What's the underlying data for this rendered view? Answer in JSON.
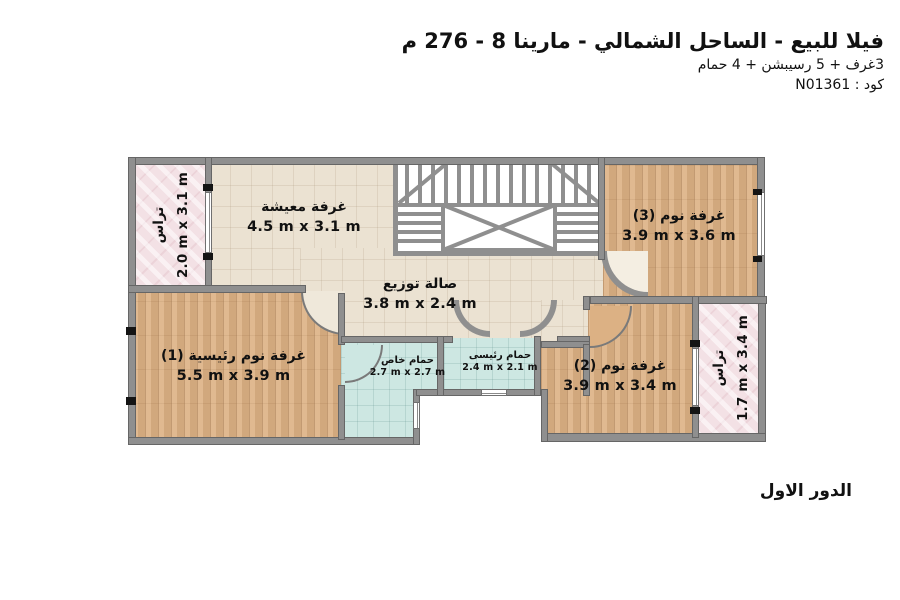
{
  "header": {
    "title": "فيلا للبيع - الساحل الشمالي - مارينا 8 - 276 م",
    "subtitle": "3غرف + 5 رسيبشن + 4 حمام",
    "code": "كود : N01361"
  },
  "floor_label": "الدور الاول",
  "rooms": {
    "terrace_top_left": {
      "name": "تراس",
      "dims": "2.0 m x 3.1 m"
    },
    "living_room": {
      "name": "غرفة معيشة",
      "dims": "4.5 m x 3.1 m"
    },
    "bedroom_3": {
      "name": "غرفة نوم (3)",
      "dims": "3.9 m x 3.6 m"
    },
    "distribution_hall": {
      "name": "صالة توزيع",
      "dims": "3.8 m x 2.4 m"
    },
    "master_bedroom": {
      "name": "غرفة نوم رئيسية (1)",
      "dims": "5.5 m x 3.9 m"
    },
    "private_bathroom": {
      "name": "حمام خاص",
      "dims": "2.7 m x 2.7 m"
    },
    "main_bathroom": {
      "name": "حمام رئيسى",
      "dims": "2.4 m x 2.1 m"
    },
    "bedroom_2": {
      "name": "غرفة نوم (2)",
      "dims": "3.9 m x 3.4 m"
    },
    "terrace_right": {
      "name": "تراس",
      "dims": "1.7 m x 3.4 m"
    }
  },
  "colors": {
    "wall": "#8f8f8f",
    "tile_beige": "#ebe2d2",
    "wood": "#dcb184",
    "bath_tile": "#cde7e2",
    "terrace_pink": "#f3e1e5",
    "text": "#111111"
  }
}
